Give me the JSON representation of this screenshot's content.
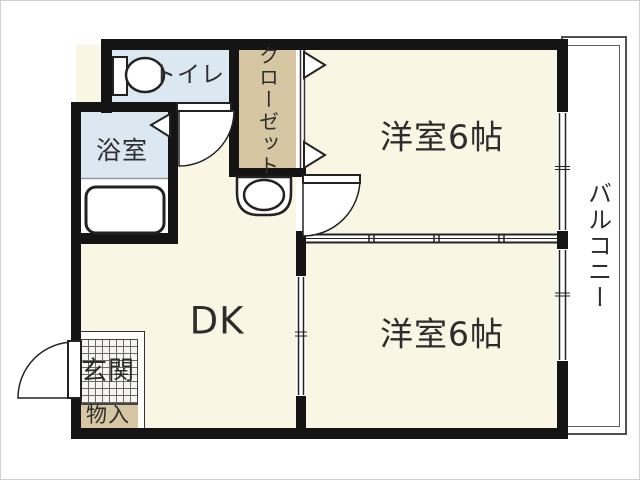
{
  "title": "1DK-floor-plan",
  "rooms": {
    "toilet": {
      "label": "トイレ"
    },
    "bathroom": {
      "label": "浴室"
    },
    "closet": {
      "label": "クローゼット"
    },
    "bedroom_top": {
      "label": "洋室6帖"
    },
    "bedroom_bottom": {
      "label": "洋室6帖"
    },
    "dining_kitchen": {
      "label": "DK"
    },
    "entrance": {
      "label": "玄関"
    },
    "storage": {
      "label": "物入"
    },
    "balcony": {
      "label": "バルコニー"
    }
  },
  "colors": {
    "room_cream": "#faf6e4",
    "wet_blue": "#dbe7f1",
    "closet_beige": "#d6c6a2",
    "wall_black": "#141414",
    "line_gray": "#3f3f3f",
    "text": "#2d2d2d",
    "balcony_white": "#ffffff"
  }
}
